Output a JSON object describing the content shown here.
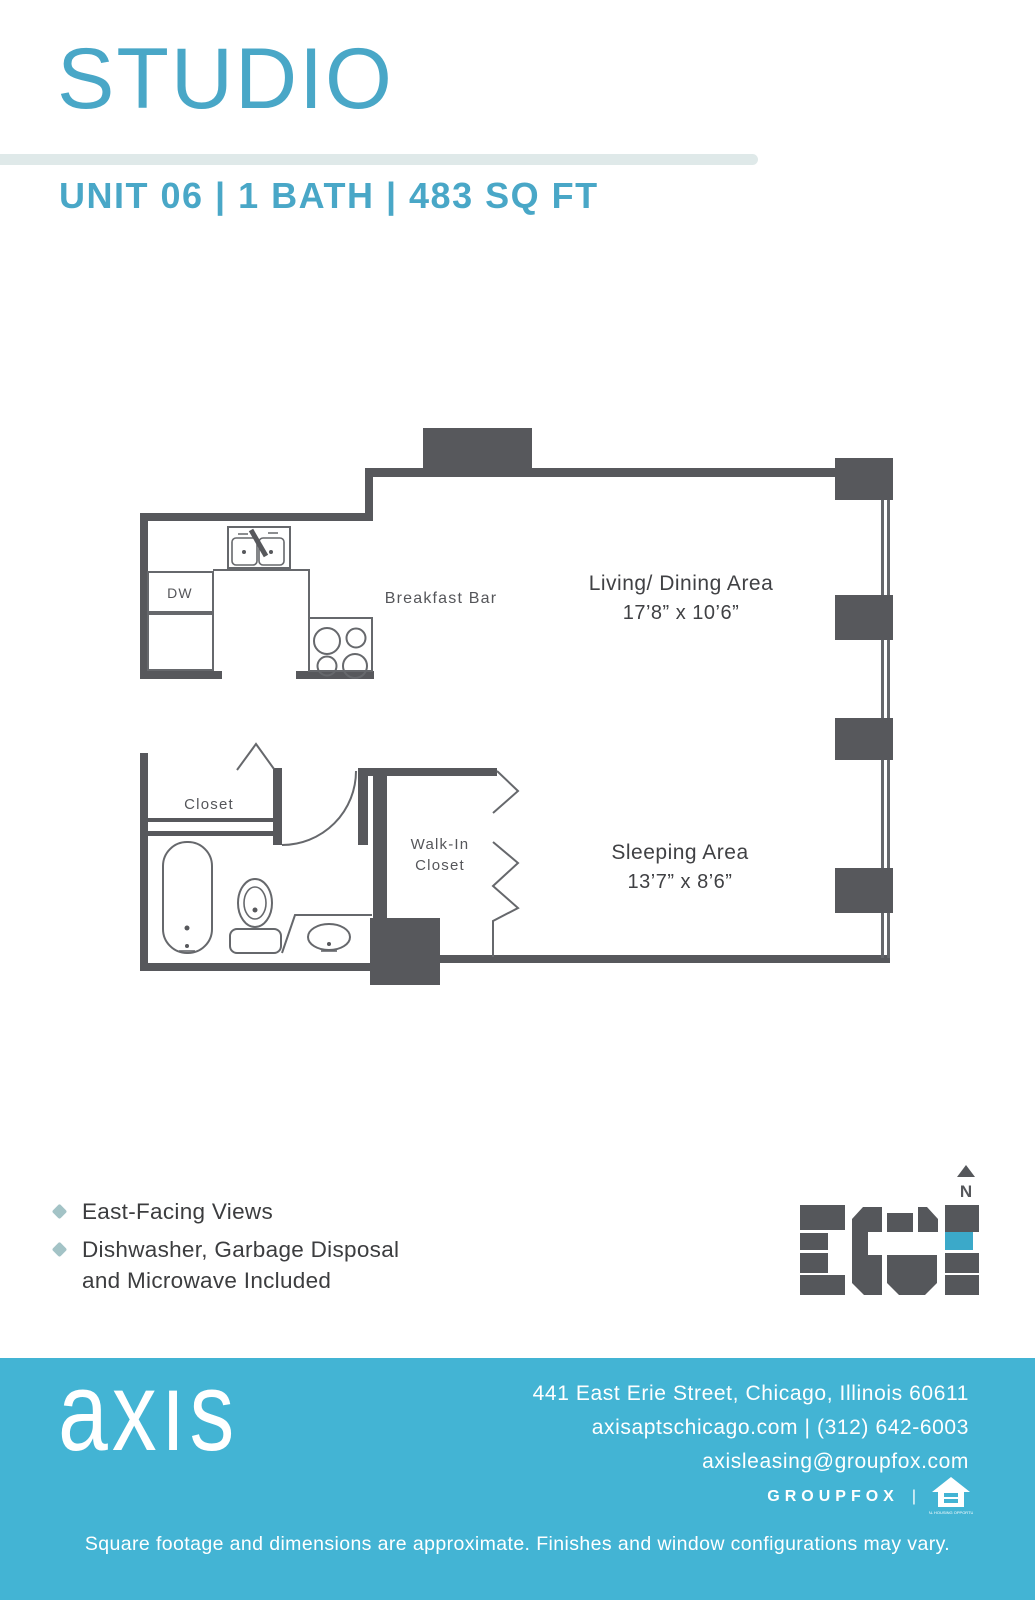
{
  "header": {
    "title": "STUDIO",
    "unit_summary": "UNIT 06 | 1 BATH | 483 SQ FT"
  },
  "floor_plan": {
    "labels": {
      "dw": "DW",
      "breakfast_bar": "Breakfast Bar",
      "living_dining": "Living/ Dining Area",
      "living_dining_dims": "17’8” x 10’6”",
      "sleeping": "Sleeping Area",
      "sleeping_dims": "13’7” x 8’6”",
      "closet": "Closet",
      "walk_in_line1": "Walk-In",
      "walk_in_line2": "Closet"
    }
  },
  "key_plan": {
    "north": "N"
  },
  "features": {
    "item1": "East-Facing Views",
    "item2_line1": "Dishwasher, Garbage Disposal",
    "item2_line2": "and Microwave Included"
  },
  "footer": {
    "logo": "axıs",
    "address": "441 East Erie Street, Chicago, Illinois 60611",
    "contact": "axisaptschicago.com | (312) 642-6003",
    "email": "axisleasing@groupfox.com",
    "brand": "GROUPFOX",
    "brand_separator": "|",
    "equal_housing_caption": "EQUAL HOUSING OPPORTUNITY",
    "disclaimer": "Square footage and dimensions are approximate. Finishes and window configurations may vary."
  },
  "icons": {
    "bullet": "diamond-icon",
    "compass": "north-arrow-icon",
    "housing": "equal-housing-icon"
  },
  "colors": {
    "accent_teal": "#49a7c7",
    "footer_teal": "#43b4d4",
    "divider": "#dfe9e9",
    "wall_gray": "#57585c",
    "line_gray": "#66686c",
    "label_gray": "#55565a",
    "room_label": "#404144",
    "text_dark": "#3c3d3f",
    "bullet_teal": "#a3c3c6",
    "keyplan_gray": "#55575b",
    "keyplan_teal": "#3ba9c9"
  }
}
